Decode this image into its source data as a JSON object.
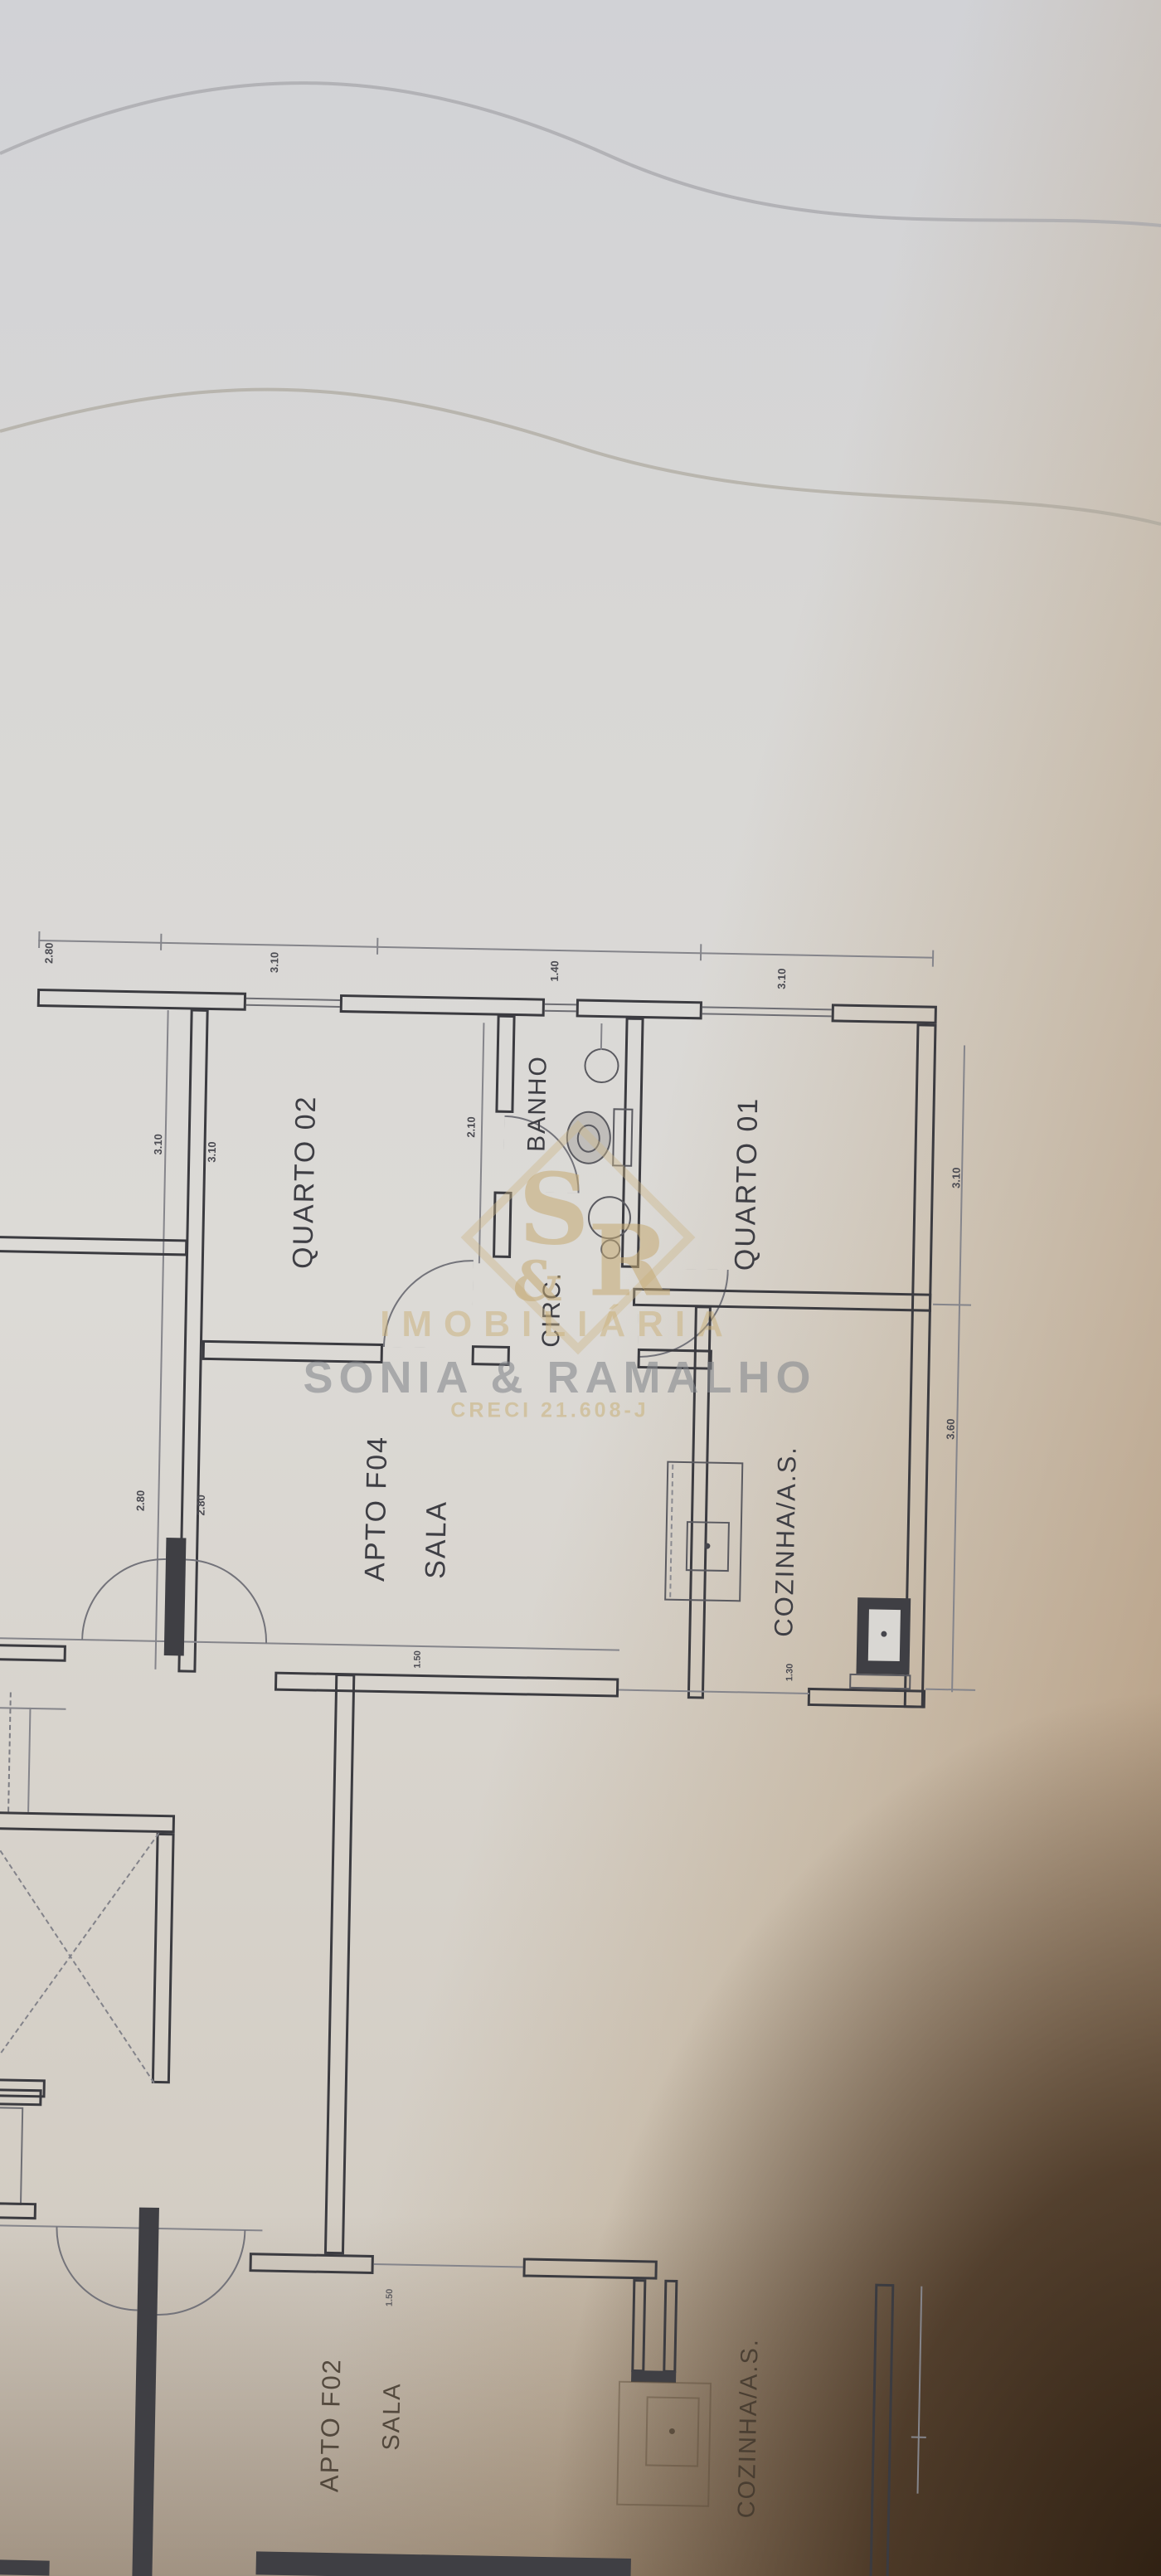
{
  "labels": {
    "quarto02": "QUARTO 02",
    "banho": "BANHO",
    "quarto01": "QUARTO 01",
    "circ": "CIRC.",
    "f04": "APTO F04",
    "f04_sala": "SALA",
    "coz_f04": "COZINHA/A.S.",
    "f02": "APTO F02",
    "f02_sala": "SALA",
    "coz_f02": "COZINHA/A.S."
  },
  "dims": [
    "2.80",
    "3.10",
    "1.40",
    "3.10",
    "3.10",
    "3.10",
    "2.80",
    "2.80",
    "2.10",
    "3.10",
    "3.60",
    "1.50",
    "1.30",
    "1.50"
  ],
  "watermark": {
    "s": "S",
    "amp": "&",
    "r": "R",
    "line1": "IMOBILIÁRIA",
    "line2": "SONIA & RAMALHO",
    "line3": "CRECI 21.608-J",
    "gold": "#c9b078",
    "gray": "#87888e"
  }
}
